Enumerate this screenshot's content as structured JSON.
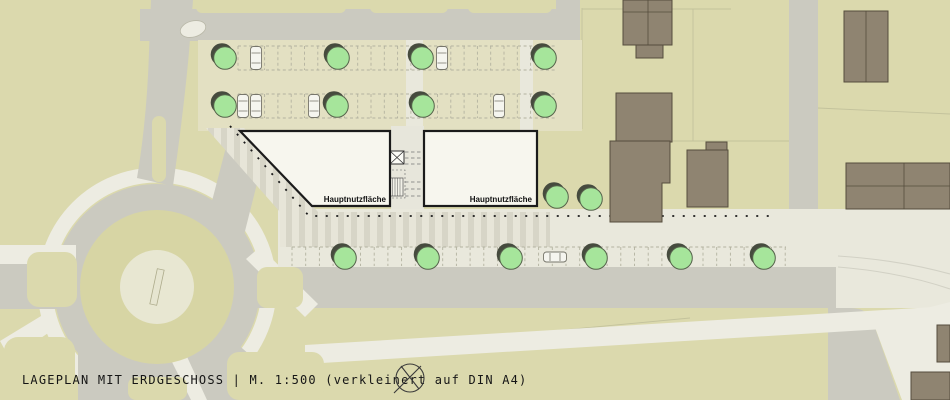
{
  "title_bar": {
    "text": "LAGEPLAN MIT ERDGESCHOSS  | M. 1:500 (verkleinert auf DIN A4)"
  },
  "plan": {
    "building_left_label": "Hauptnutzfläche",
    "building_right_label": "Hauptnutzfläche"
  },
  "symbols": {
    "north_marker": "crossed-circle-survey-symbol",
    "elevator": "box-with-x",
    "stairs": "hatched-box"
  },
  "palette": {
    "parcel": "#DBD9AD",
    "road": "#CBCAC0",
    "path": "#EDECE2",
    "lot": "#E3E0C2",
    "sidewalk": "#E9E8DC",
    "stripe_light": "#E7E5D8",
    "stripe_dark": "#D7D5C7",
    "building_new": "#F7F6EE",
    "building_existing": "#8F8471",
    "building_existing_stroke": "#554D3D",
    "tree": "#A6E59B",
    "tree_stroke": "#55634B",
    "tree_shadow": "#464B3E",
    "marking": "#B3B2A0",
    "ink": "#1B1B1B"
  },
  "map": {
    "trees": [
      {
        "x": 225,
        "y": 58
      },
      {
        "x": 338,
        "y": 58
      },
      {
        "x": 422,
        "y": 58
      },
      {
        "x": 545,
        "y": 58
      },
      {
        "x": 225,
        "y": 106
      },
      {
        "x": 337,
        "y": 106
      },
      {
        "x": 423,
        "y": 106
      },
      {
        "x": 545,
        "y": 106
      },
      {
        "x": 557,
        "y": 197
      },
      {
        "x": 591,
        "y": 199
      },
      {
        "x": 345,
        "y": 258
      },
      {
        "x": 428,
        "y": 258
      },
      {
        "x": 511,
        "y": 258
      },
      {
        "x": 596,
        "y": 258
      },
      {
        "x": 681,
        "y": 258
      },
      {
        "x": 764,
        "y": 258
      }
    ],
    "cars": [
      {
        "x": 256,
        "y": 58,
        "o": "v"
      },
      {
        "x": 442,
        "y": 58,
        "o": "v"
      },
      {
        "x": 243,
        "y": 106,
        "o": "v"
      },
      {
        "x": 256,
        "y": 106,
        "o": "v"
      },
      {
        "x": 314,
        "y": 106,
        "o": "v"
      },
      {
        "x": 499,
        "y": 106,
        "o": "v"
      },
      {
        "x": 555,
        "y": 257,
        "o": "h"
      }
    ],
    "stall_rows": [
      {
        "x1": 238,
        "x2": 556,
        "y1": 46,
        "y2": 70,
        "step": 13.3,
        "both": true
      },
      {
        "x1": 238,
        "x2": 556,
        "y1": 94,
        "y2": 118,
        "step": 13.3,
        "both": true
      },
      {
        "x1": 292,
        "x2": 786,
        "y1": 247,
        "y2": 266,
        "step": 13.7,
        "both": false
      }
    ]
  }
}
